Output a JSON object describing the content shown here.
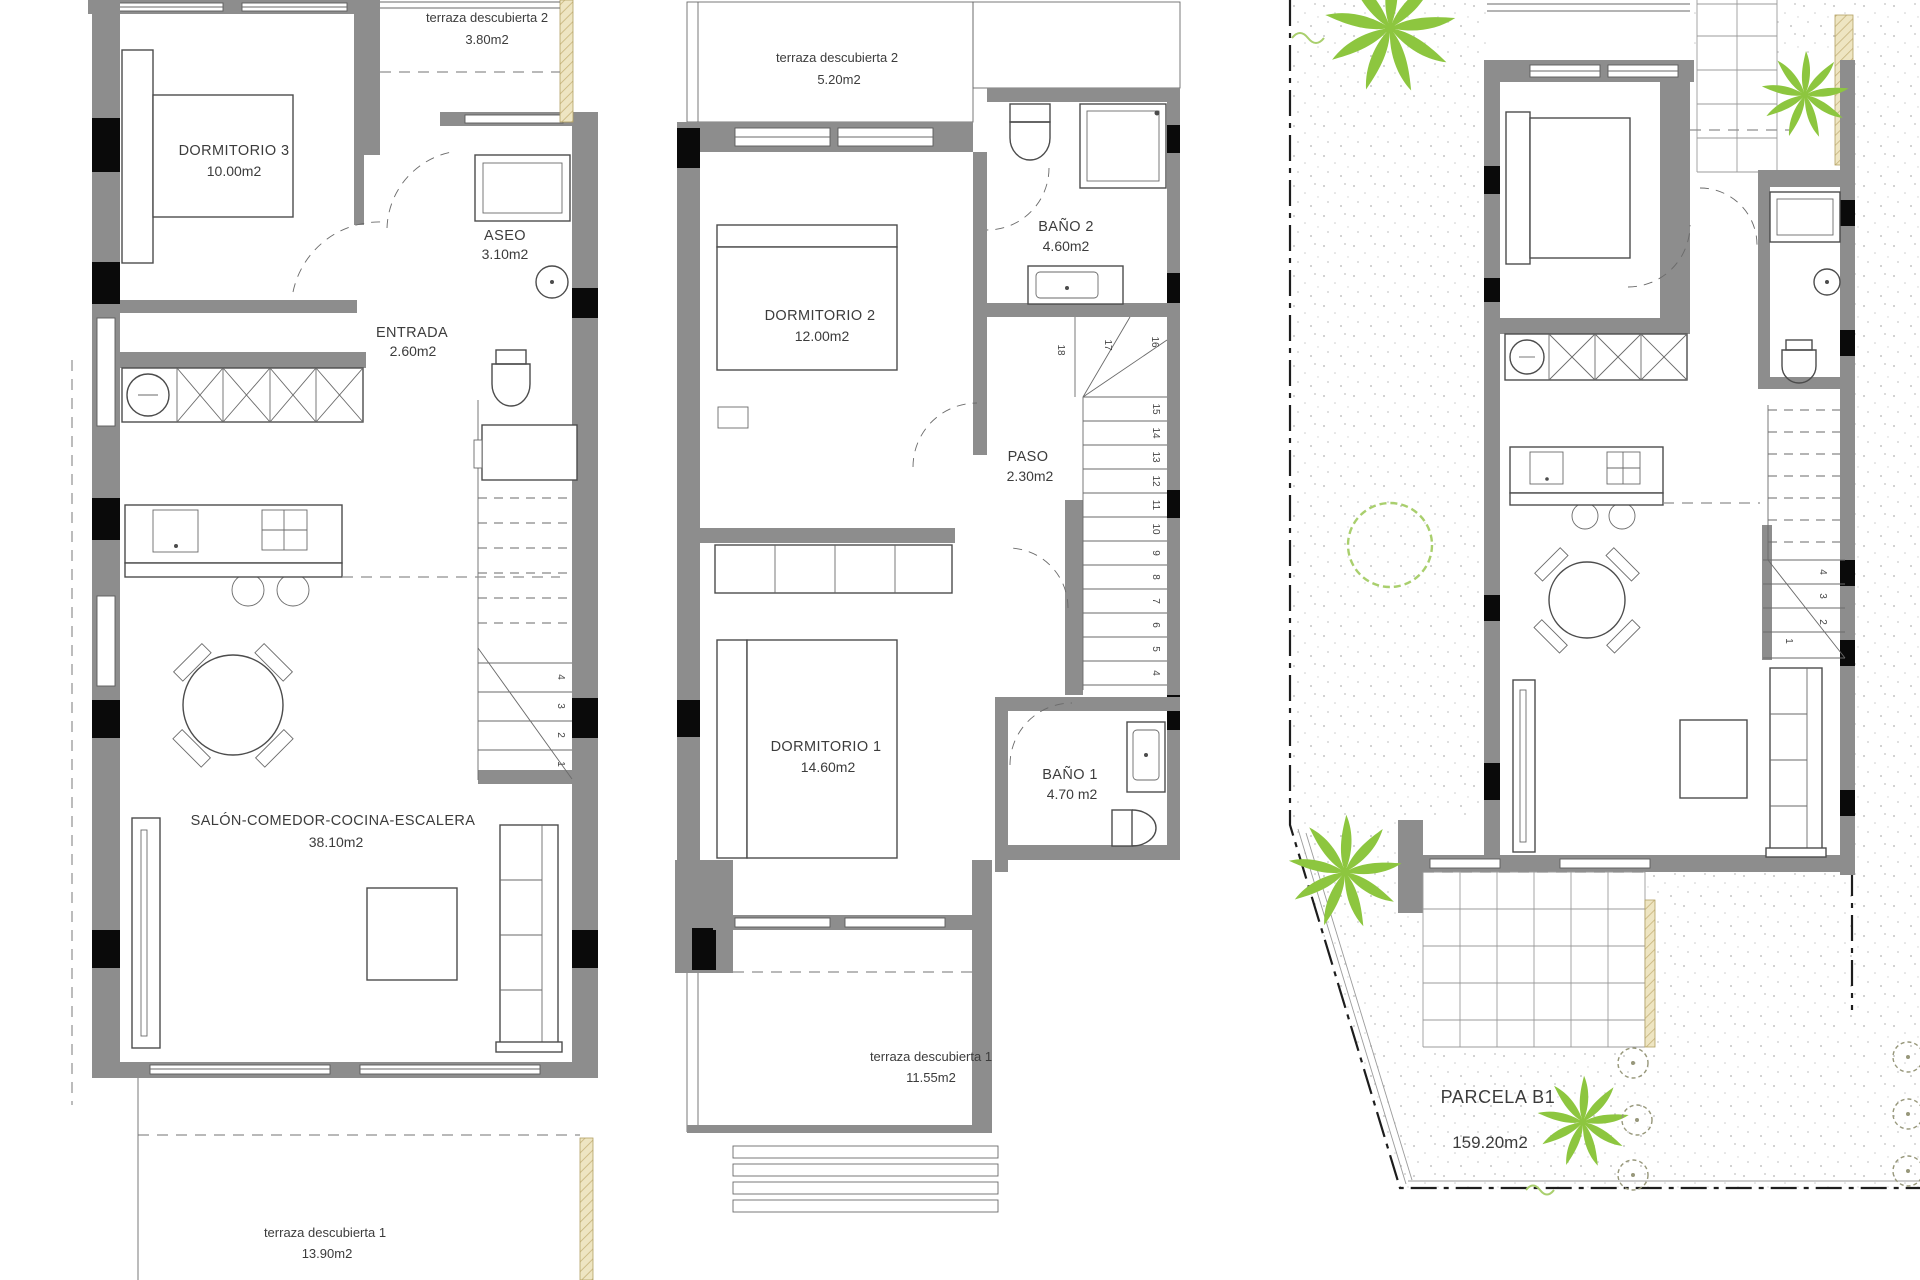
{
  "document": {
    "type": "architectural floor plan",
    "panels": [
      "ground floor",
      "first floor",
      "site plan"
    ]
  },
  "colors": {
    "wall_gray": "#8d8d8d",
    "column_black": "#0a0a0a",
    "line": "#4c4c4c",
    "tan_hatch": "#ebe2c0",
    "palm_green": "#8dc63f",
    "shrub_outline": "#a9cf6d",
    "stipple": "#c3c3c3",
    "text": "#3c3c3c"
  },
  "ground_floor": {
    "rooms": {
      "dormitorio3": {
        "name": "DORMITORIO 3",
        "area": "10.00m2"
      },
      "terraza2": {
        "name": "terraza descubierta 2",
        "area": "3.80m2"
      },
      "aseo": {
        "name": "ASEO",
        "area": "3.10m2"
      },
      "entrada": {
        "name": "ENTRADA",
        "area": "2.60m2"
      },
      "salon": {
        "name": "SALÓN-COMEDOR-COCINA-ESCALERA",
        "area": "38.10m2"
      },
      "terraza1": {
        "name": "terraza descubierta 1",
        "area": "13.90m2"
      }
    },
    "stair_steps": [
      "1",
      "2",
      "3",
      "4"
    ]
  },
  "first_floor": {
    "rooms": {
      "terraza2": {
        "name": "terraza descubierta 2",
        "area": "5.20m2"
      },
      "dormitorio2": {
        "name": "DORMITORIO 2",
        "area": "12.00m2"
      },
      "bano2": {
        "name": "BAÑO 2",
        "area": "4.60m2"
      },
      "paso": {
        "name": "PASO",
        "area": "2.30m2"
      },
      "dormitorio1": {
        "name": "DORMITORIO 1",
        "area": "14.60m2"
      },
      "bano1": {
        "name": "BAÑO 1",
        "area": "4.70 m2"
      },
      "terraza1": {
        "name": "terraza descubierta 1",
        "area": "11.55m2"
      }
    },
    "stair_steps": [
      "4",
      "5",
      "6",
      "7",
      "8",
      "9",
      "10",
      "11",
      "12",
      "13",
      "14",
      "15",
      "16",
      "17",
      "18"
    ]
  },
  "site_plan": {
    "parcel": {
      "name": "PARCELA B1",
      "area": "159.20m2"
    },
    "stair_steps": [
      "1",
      "2",
      "3",
      "4"
    ]
  }
}
